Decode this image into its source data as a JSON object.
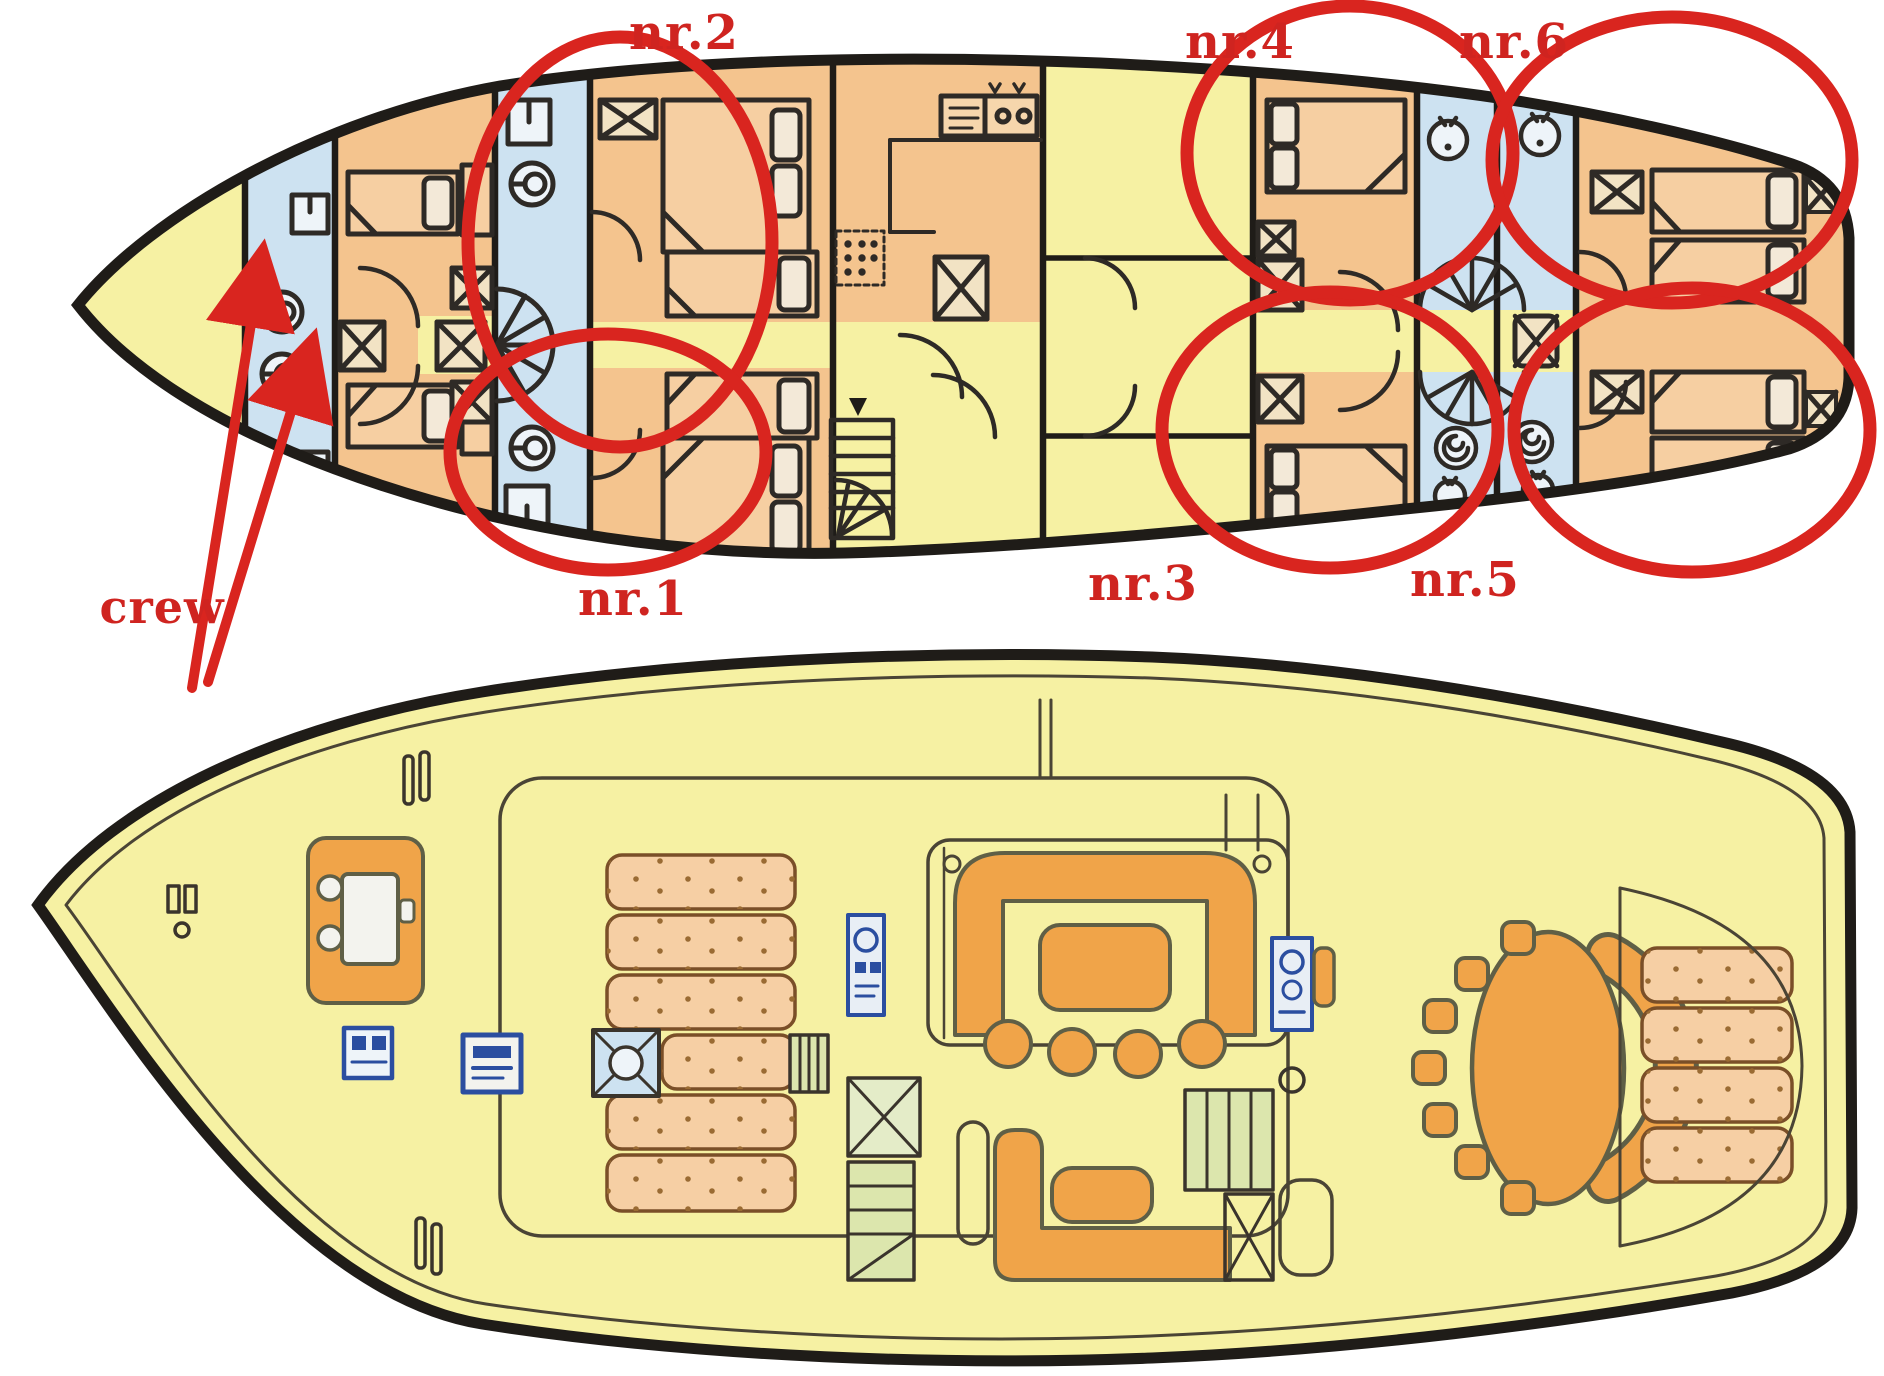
{
  "colors": {
    "background": "#ffffff",
    "hull_fill": "#f6f1a3",
    "cabin_fill": "#f4c48e",
    "bathroom_fill": "#cde2f1",
    "furniture_orange": "#f0a449",
    "mattress_fill": "#f6cfa4",
    "steps_green": "#dce6ad",
    "annotation_red": "#d9251f",
    "outline_black": "#1f1c18"
  },
  "labels": {
    "crew": "crew",
    "cabins": [
      {
        "text": "nr.1"
      },
      {
        "text": "nr.2"
      },
      {
        "text": "nr.3"
      },
      {
        "text": "nr.4"
      },
      {
        "text": "nr.5"
      },
      {
        "text": "nr.6"
      }
    ]
  }
}
